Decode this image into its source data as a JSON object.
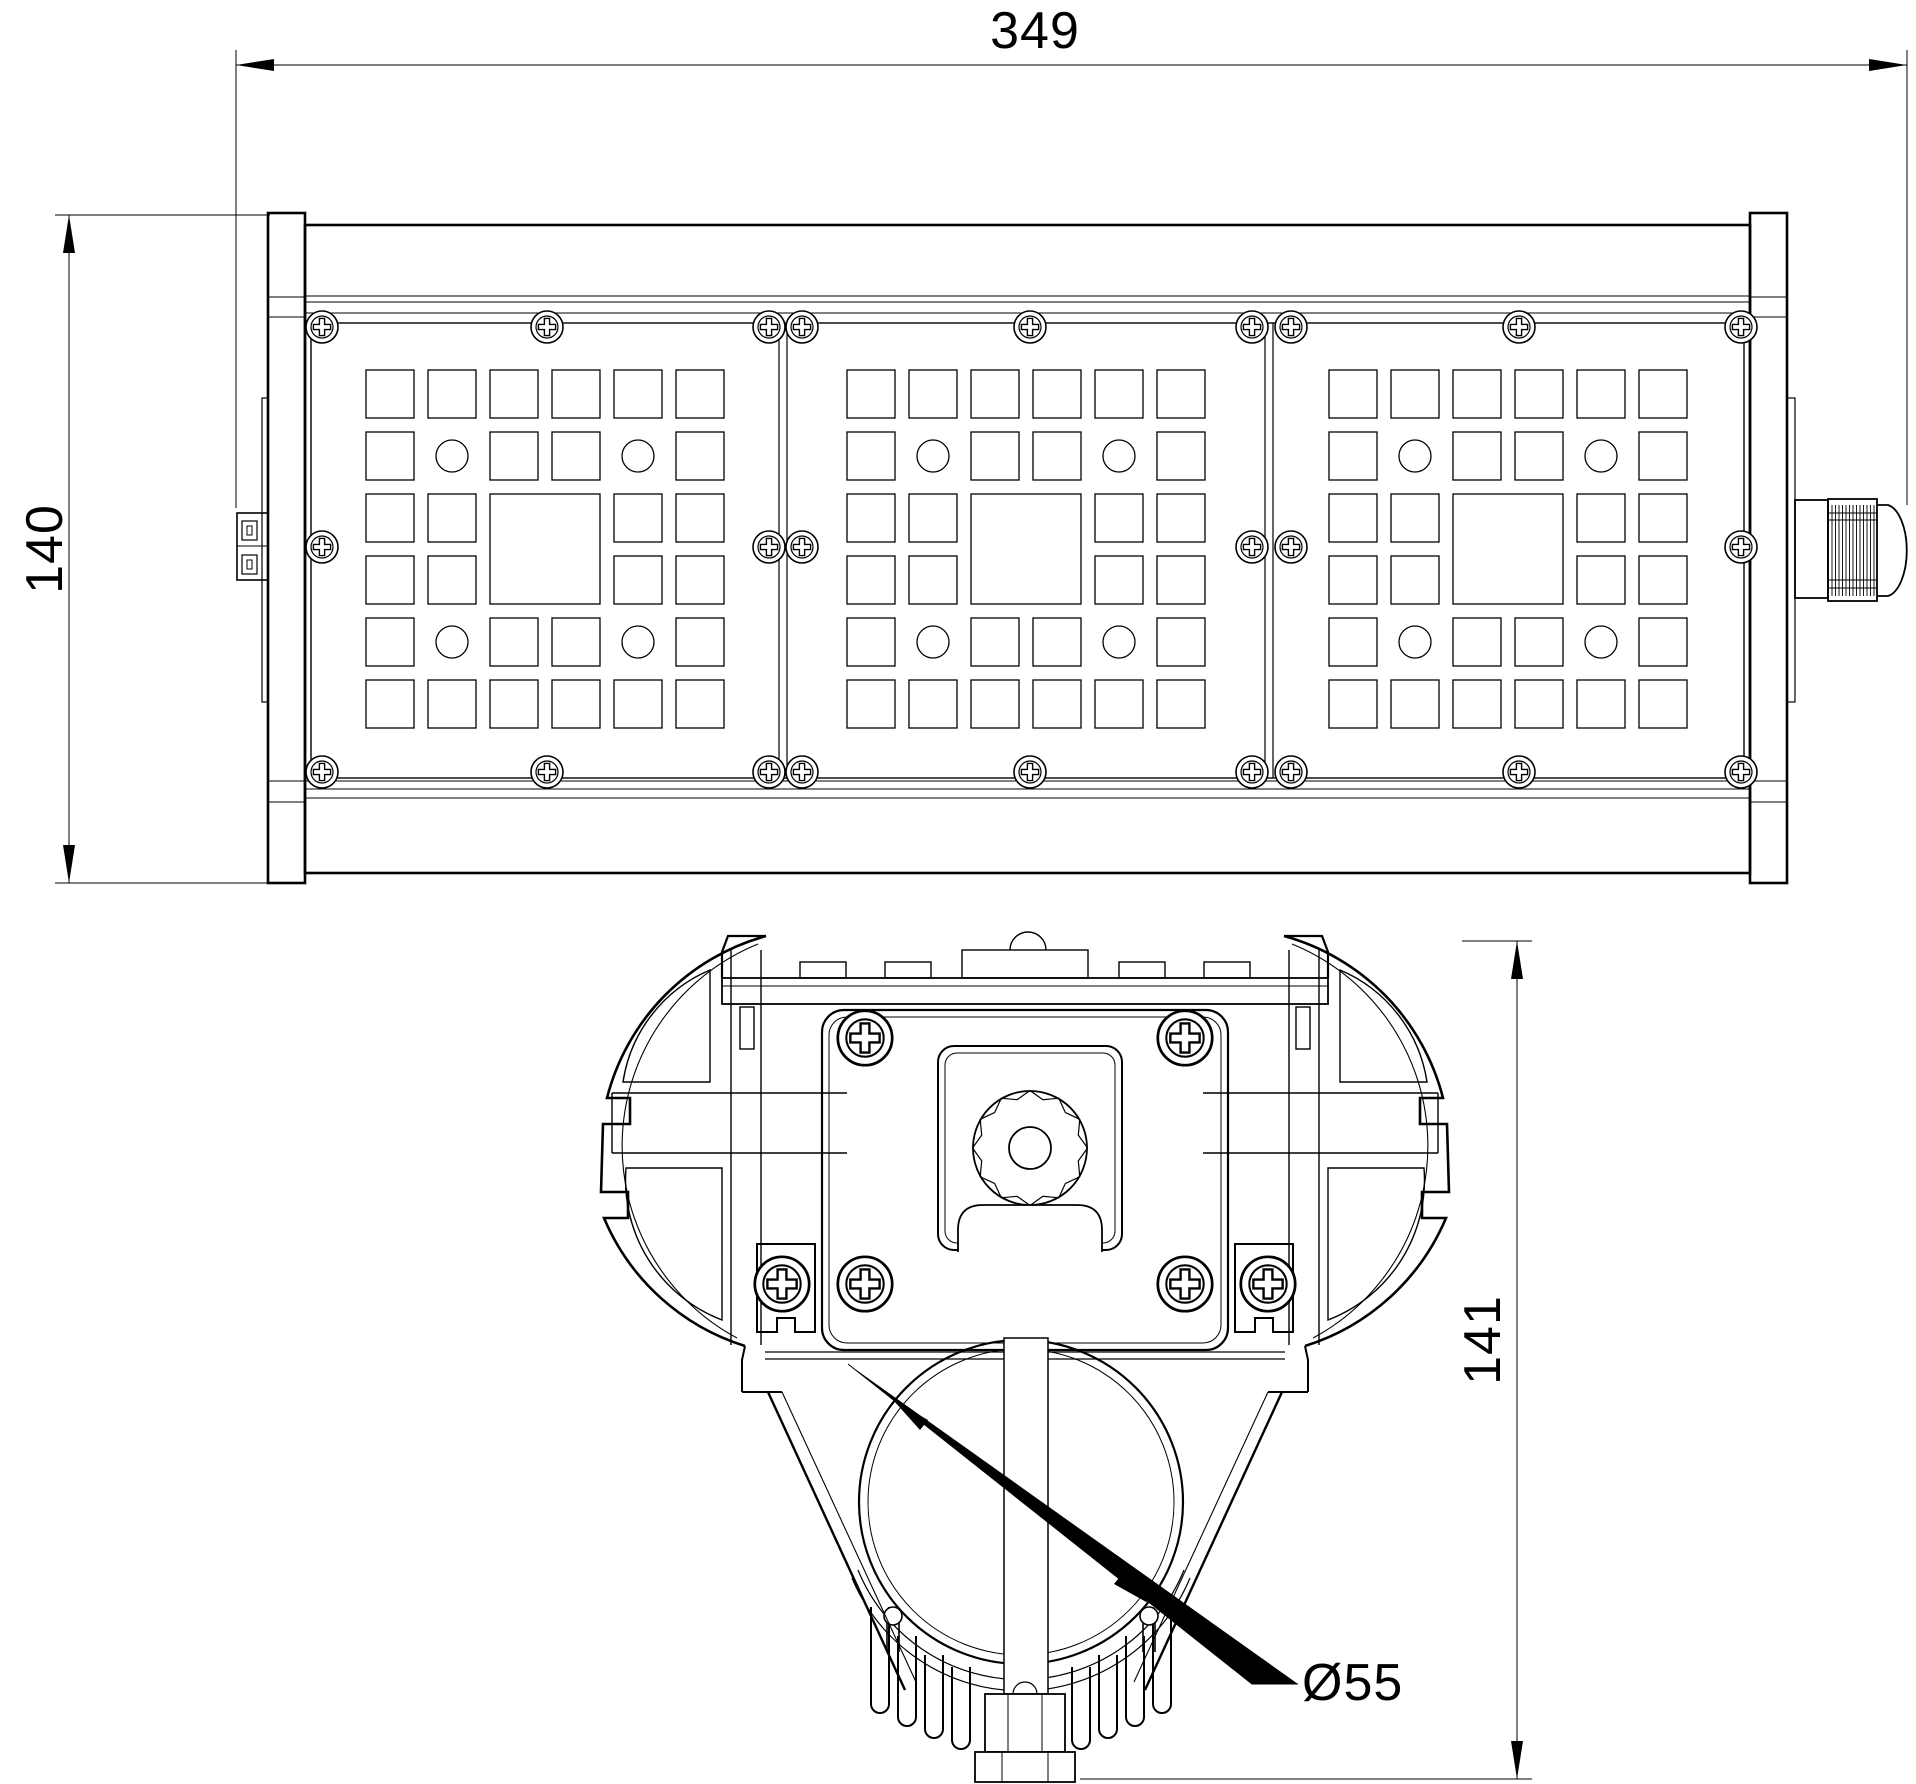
{
  "page": {
    "background": "#ffffff",
    "line_color": "#000000"
  },
  "drawing": {
    "title": "Linear LED luminaire dimensional drawing",
    "dimensions": {
      "overall_width": "349",
      "overall_height": "140",
      "section_height": "141",
      "tube_diameter": "Ø55"
    }
  }
}
